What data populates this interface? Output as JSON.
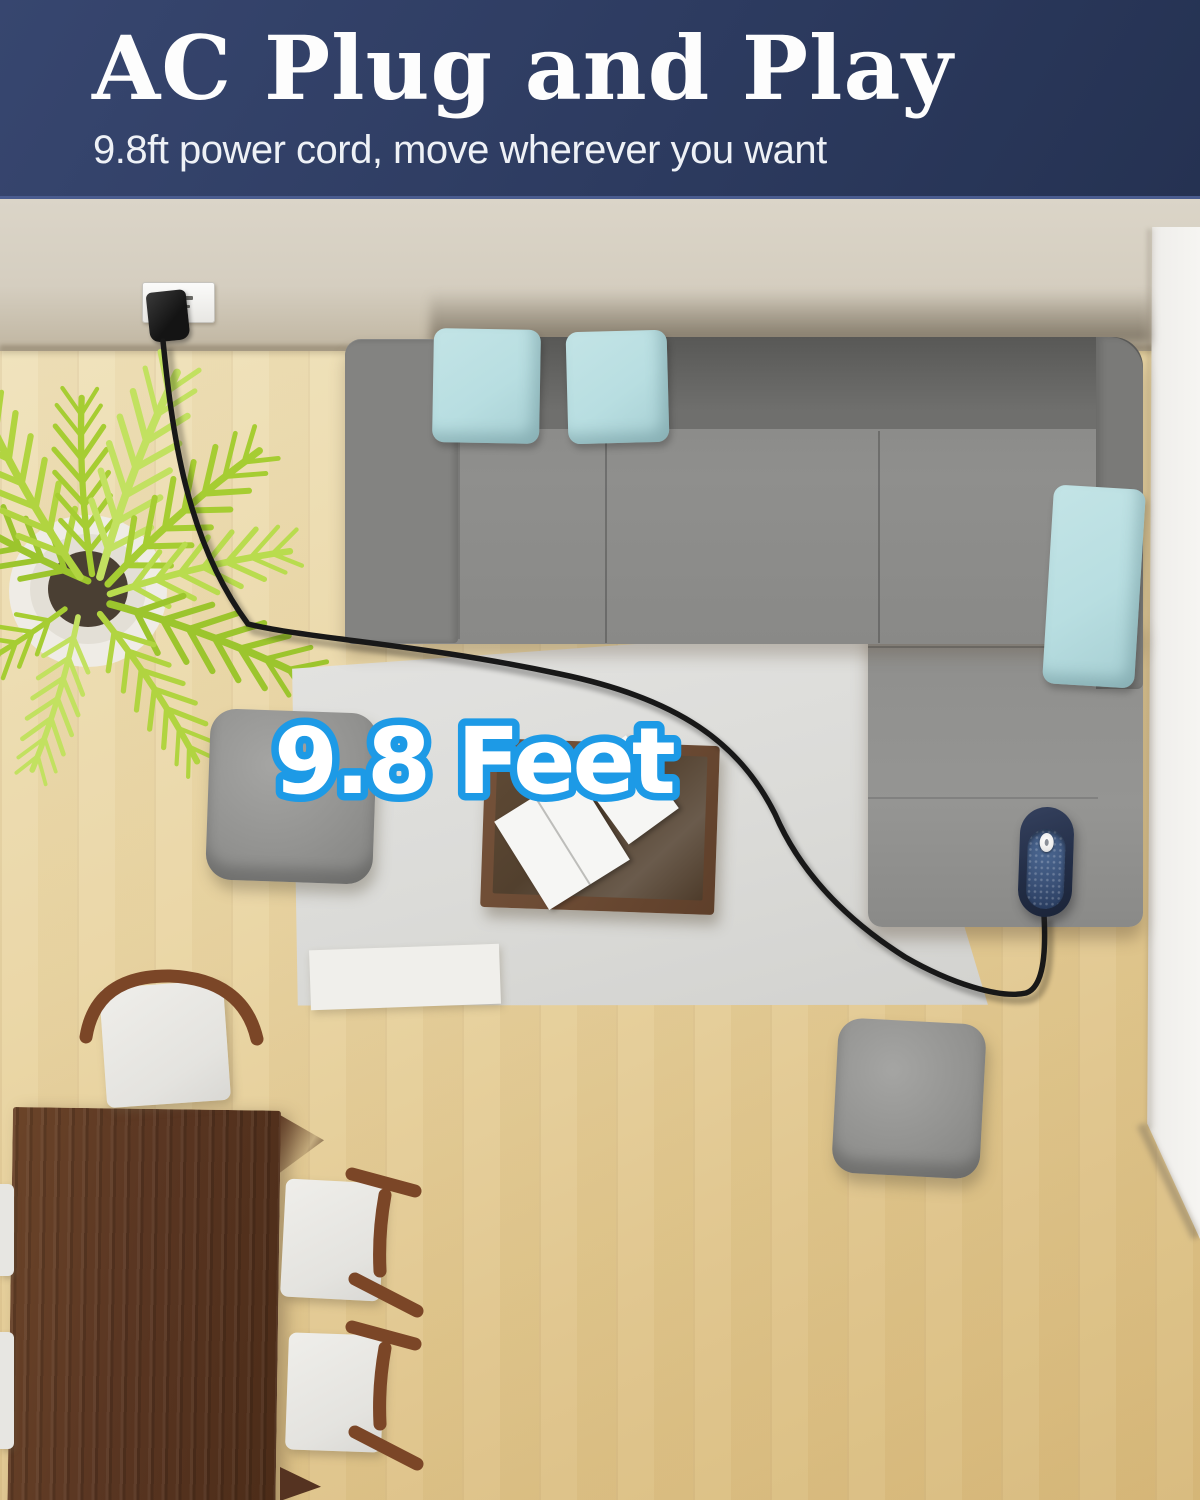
{
  "header": {
    "title": "AC Plug and Play",
    "subtitle": "9.8ft power cord, move wherever you want",
    "background_color": "#2d3b60",
    "divider_color": "#4a5c8f",
    "text_color": "#ffffff"
  },
  "overlay": {
    "distance_label": "9.8 Feet",
    "fill_color": "#ffffff",
    "outline_color": "#1d9ae6"
  },
  "palette": {
    "wall_beige": "#d7d0c3",
    "floor_wood_light": "#efe0b6",
    "floor_wood_dark": "#d8b97a",
    "sofa_gray": "#8d8d8b",
    "pillow_teal": "#b8dee1",
    "rug_gray": "#dcdcda",
    "coffee_table_brown": "#6b4a33",
    "desk_walnut": "#5a3622",
    "chair_wood_brown": "#7b4627",
    "cushion_white": "#e9e8e4",
    "plant_green": "#aed13c",
    "power_cord_black": "#181818",
    "device_navy": "#2c3a57",
    "outlet_white": "#f4f3f0",
    "right_column_white": "#f0efec"
  }
}
